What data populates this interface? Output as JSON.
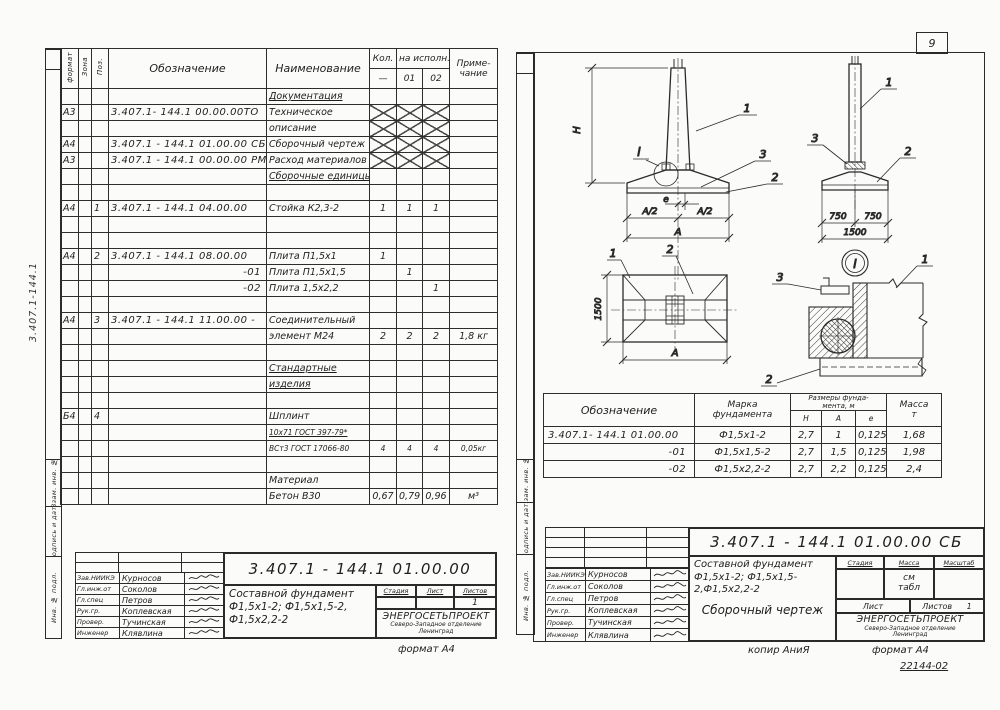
{
  "page": {
    "number": "9"
  },
  "signatories": [
    {
      "role": "Зав.НИИКЭ",
      "name": "Курносов"
    },
    {
      "role": "Гл.инж.от",
      "name": "Соколов"
    },
    {
      "role": "Гл.спец",
      "name": "Петров"
    },
    {
      "role": "Рук.гр.",
      "name": "Коплевская"
    },
    {
      "role": "Провер.",
      "name": "Тучинская"
    },
    {
      "role": "Инженер",
      "name": "Клявлина"
    }
  ],
  "left_sheet": {
    "margin_code": "3.407.1-144.1",
    "side_stamp": {
      "vzam": "Взам. инв. №",
      "podpis": "Подпись и дата",
      "inv": "Инв. № подл."
    },
    "spec_table": {
      "headers": {
        "format": "формат",
        "zone": "Зона",
        "pos": "Поз.",
        "designation": "Обозначение",
        "name": "Наименование",
        "qty": "Кол.",
        "per_version": "на исполн.",
        "dash": "—",
        "v01": "01",
        "v02": "02",
        "note1": "Приме-",
        "note2": "чание"
      },
      "rows": [
        {
          "name": "Документация",
          "section": true
        },
        {
          "format": "А3",
          "designation": "3.407.1- 144.1  00.00.00ТО",
          "name": "Техническое",
          "crossed": true
        },
        {
          "name": "описание",
          "crossed": true
        },
        {
          "format": "А4",
          "designation": "3.407.1 - 144.1  01.00.00 СБ",
          "name": "Сборочный чертеж",
          "crossed": true
        },
        {
          "format": "А3",
          "designation": "3.407.1 - 144.1  00.00.00 РМ",
          "name": "Расход материалов",
          "crossed": true
        },
        {
          "name": "Сборочные единицы",
          "section": true
        },
        {},
        {
          "format": "А4",
          "pos": "1",
          "designation": "3.407.1 - 144.1  04.00.00",
          "name": "Стойка К2,3-2",
          "q0": "1",
          "q1": "1",
          "q2": "1"
        },
        {},
        {},
        {
          "format": "А4",
          "pos": "2",
          "designation": "3.407.1 - 144.1  08.00.00",
          "name": "Плита П1,5х1",
          "q0": "1"
        },
        {
          "designation": "-01",
          "name": "Плита П1,5х1,5",
          "q1": "1",
          "align": "right"
        },
        {
          "designation": "-02",
          "name": "Плита 1,5х2,2",
          "q2": "1",
          "align": "right"
        },
        {},
        {
          "format": "А4",
          "pos": "3",
          "designation": "3.407.1 - 144.1  11.00.00 -",
          "name": "Соединительный"
        },
        {
          "name": "элемент М24",
          "q0": "2",
          "q1": "2",
          "q2": "2",
          "note": "1,8 кг"
        },
        {},
        {
          "name": "Стандартные",
          "section": true
        },
        {
          "name": "изделия",
          "section": true
        },
        {},
        {
          "format": "Б4",
          "pos": "4",
          "name": "Шплинт"
        },
        {
          "name": "10х71 ГОСТ 397-79*",
          "section": true,
          "small": true
        },
        {
          "name": "ВСт3  ГОСТ 17066-80",
          "small": true,
          "q0": "4",
          "q1": "4",
          "q2": "4",
          "note": "0,05кг"
        },
        {},
        {
          "name": "Материал"
        },
        {
          "name": "Бетон В30",
          "q0": "0,67",
          "q1": "0,79",
          "q2": "0,96",
          "note": "м³"
        }
      ]
    },
    "title_block": {
      "doc_number": "3.407.1 - 144.1   01.00.00",
      "title_line1": "Составной фундамент",
      "title_line2": "Ф1,5х1-2;  Ф1,5х1,5-2,",
      "title_line3": "Ф1,5х2,2-2",
      "stage_label": "Стадия",
      "sheet_label": "Лист",
      "sheets_label": "Листов",
      "sheets_value": "1",
      "org_name": "ЭНЕРГОСЕТЬПРОЕКТ",
      "org_branch": "Северо-Западное отделение",
      "org_city": "Ленинград"
    },
    "format_note": "формат А4"
  },
  "right_sheet": {
    "side_stamp": {
      "vzam": "Взам. инв. №",
      "podpis": "Подпись и дата",
      "inv": "Инв. № подл."
    },
    "drawing": {
      "callout_post": "1",
      "callout_plate": "2",
      "callout_collar": "3",
      "detail_mark": "I",
      "dim_h": "Н",
      "dim_e": "е",
      "dim_a_half": "А/2",
      "dim_a": "А",
      "dim_750": "750",
      "dim_1500": "1500"
    },
    "marks_table": {
      "headers": {
        "designation": "Обозначение",
        "mark_l1": "Марка",
        "mark_l2": "фундамента",
        "dims_l1": "Размеры фунда-",
        "dims_l2": "мента, м",
        "h": "Н",
        "a": "А",
        "e": "е",
        "mass_l1": "Масса",
        "mass_l2": "т"
      },
      "rows": [
        {
          "designation": "3.407.1- 144.1  01.00.00",
          "mark": "Ф1,5х1-2",
          "h": "2,7",
          "a": "1",
          "e": "0,125",
          "mass": "1,68"
        },
        {
          "designation": "-01",
          "mark": "Ф1,5х1,5-2",
          "h": "2,7",
          "a": "1,5",
          "e": "0,125",
          "mass": "1,98",
          "align": "right"
        },
        {
          "designation": "-02",
          "mark": "Ф1,5х2,2-2",
          "h": "2,7",
          "a": "2,2",
          "e": "0,125",
          "mass": "2,4",
          "align": "right"
        }
      ]
    },
    "title_block": {
      "doc_number": "3.407.1 - 144.1   01.00.00 СБ",
      "title_line1": "Составной фундамент",
      "title_line2": "Ф1,5х1-2; Ф1,5х1,5-2,Ф1,5х2,2-2",
      "subtitle": "Сборочный чертеж",
      "stage_label": "Стадия",
      "mass_label": "Масса",
      "scale_label": "Масштаб",
      "mass_value_l1": "см",
      "mass_value_l2": "табл",
      "sheet_label": "Лист",
      "sheets_label": "Листов",
      "sheets_value": "1",
      "org_name": "ЭНЕРГОСЕТЬПРОЕКТ",
      "org_branch": "Северо-Западное отделение",
      "org_city": "Ленинград"
    },
    "notes": {
      "copy": "копир АниЯ",
      "format": "формат А4",
      "code": "22144-02"
    }
  }
}
